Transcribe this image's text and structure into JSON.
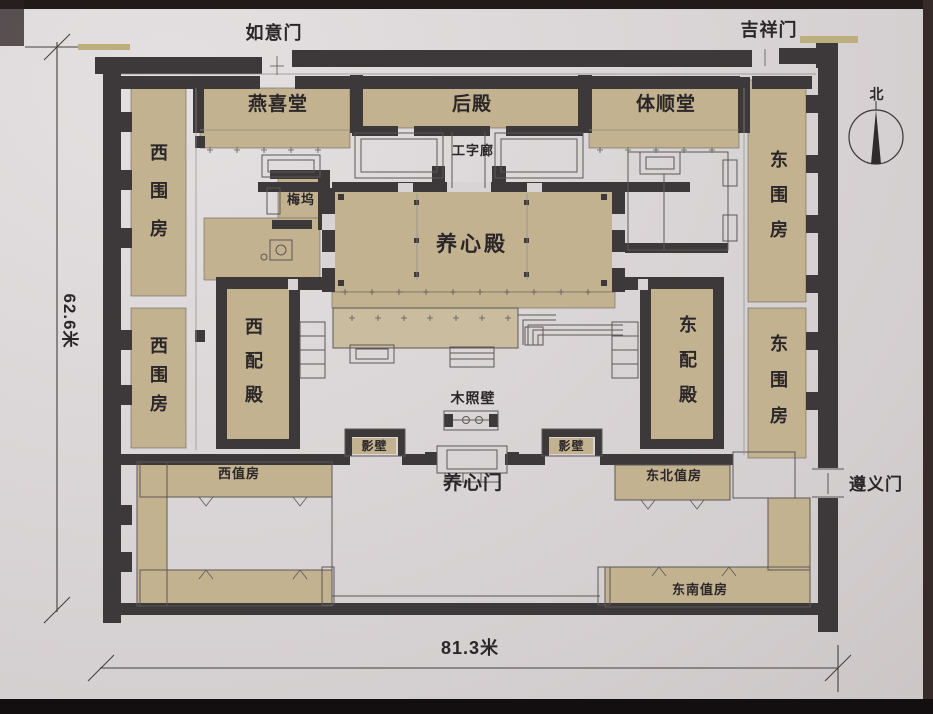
{
  "colors": {
    "wall": "#3d393b",
    "building_fill": "#c2b290",
    "terrace_fill": "#cabd9f",
    "paper": "#d8d3d4",
    "line": "#5d5856",
    "faint_line": "#918b89",
    "dim_line": "#45413f",
    "text": "#2b2628",
    "highlight_mark": "#bdae7e"
  },
  "compass": {
    "north": "北"
  },
  "dimensions": {
    "vertical": "62.6米",
    "horizontal": "81.3米"
  },
  "gates": {
    "ruyi": "如意门",
    "jixiang": "吉祥门",
    "zunyi": "遵义门",
    "yangxin": "养心门"
  },
  "buildings": {
    "yanxi_hall": "燕喜堂",
    "rear_hall": "后殿",
    "tishun_hall": "体顺堂",
    "gongzi_corridor": "工字廊",
    "meiwu": "梅坞",
    "yangxin_hall": "养心殿",
    "west_wing_upper": "西围房",
    "west_wing_lower": "西围房",
    "east_wing_upper": "东围房",
    "east_wing_lower": "东围房",
    "west_annex": "西配殿",
    "east_annex": "东配殿",
    "wood_screen": "木照壁",
    "screen_west": "影壁",
    "screen_east": "影壁",
    "west_duty": "西值房",
    "northeast_duty": "东北值房",
    "southeast_duty": "东南值房"
  }
}
